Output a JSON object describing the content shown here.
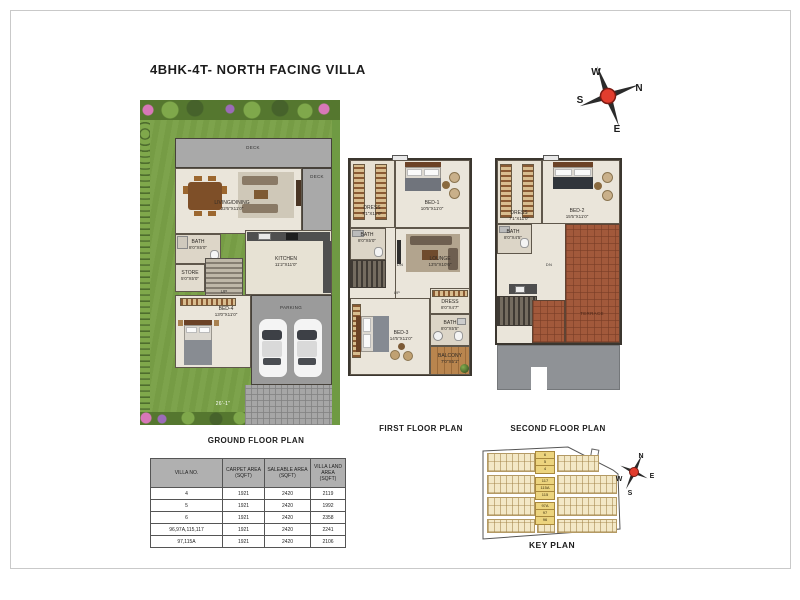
{
  "title": "4BHK-4T- NORTH FACING VILLA",
  "compass": {
    "n": "N",
    "s": "S",
    "e": "E",
    "w": "W"
  },
  "plans": {
    "ground": {
      "title": "GROUND FLOOR PLAN",
      "deck": "DECK",
      "deck2": "DECK",
      "living_name": "LIVING/DINING",
      "living_dims": "22'6\"X11'0\"",
      "bath_name": "BATH",
      "bath_dims": "8'0\"X5'0\"",
      "store_name": "STORE",
      "store_dims": "5'0\"X5'0\"",
      "kitchen_name": "KITCHEN",
      "kitchen_dims": "11'2\"X11'0\"",
      "bed_name": "BED-4",
      "bed_dims": "13'0\"X11'0\"",
      "parking": "PARKING",
      "up": "UP",
      "plot_dim": "26'-1\""
    },
    "first": {
      "title": "FIRST FLOOR PLAN",
      "dress1_name": "DRESS",
      "dress1_dims": "7'1\"X11'0\"",
      "bed1_name": "BED-1",
      "bed1_dims": "10'5\"X11'0\"",
      "bath1_name": "BATH",
      "bath1_dims": "8'0\"X5'0\"",
      "lounge_name": "LOUNGE",
      "lounge_dims": "13'5\"X10'6\"",
      "bed3_name": "BED-3",
      "bed3_dims": "14'5\"X11'0\"",
      "dress2_name": "DRESS",
      "dress2_dims": "8'0\"X4'7\"",
      "bath2_name": "BATH",
      "bath2_dims": "8'0\"X5'5\"",
      "balcony_name": "BALCONY",
      "balcony_dims": "7'0\"X5'1\"",
      "up": "UP",
      "dn": "DN"
    },
    "second": {
      "title": "SECOND FLOOR PLAN",
      "dress_name": "DRESS",
      "dress_dims": "7'1\"X11'0\"",
      "bed2_name": "BED-2",
      "bed2_dims": "15'5\"X11'0\"",
      "bath_name": "BATH",
      "bath_dims": "8'0\"X4'5\"",
      "terrace": "TERRACE",
      "dn": "DN"
    }
  },
  "table": {
    "headers": [
      "VILLA NO.",
      "CARPET AREA (SQFT)",
      "SALEABLE AREA (SQFT)",
      "VILLA LAND AREA (SQFT)"
    ],
    "rows": [
      [
        "4",
        "1921",
        "2420",
        "2119"
      ],
      [
        "5",
        "1921",
        "2420",
        "1992"
      ],
      [
        "6",
        "1921",
        "2420",
        "2358"
      ],
      [
        "96,97A,115,117",
        "1921",
        "2420",
        "2241"
      ],
      [
        "97,115A",
        "1921",
        "2420",
        "2106"
      ]
    ]
  },
  "key_plan": {
    "title": "KEY PLAN",
    "groups": [
      [
        "6",
        "5",
        "4"
      ],
      [
        "117",
        "115A",
        "115"
      ],
      [
        "97A",
        "97",
        "96"
      ]
    ]
  }
}
